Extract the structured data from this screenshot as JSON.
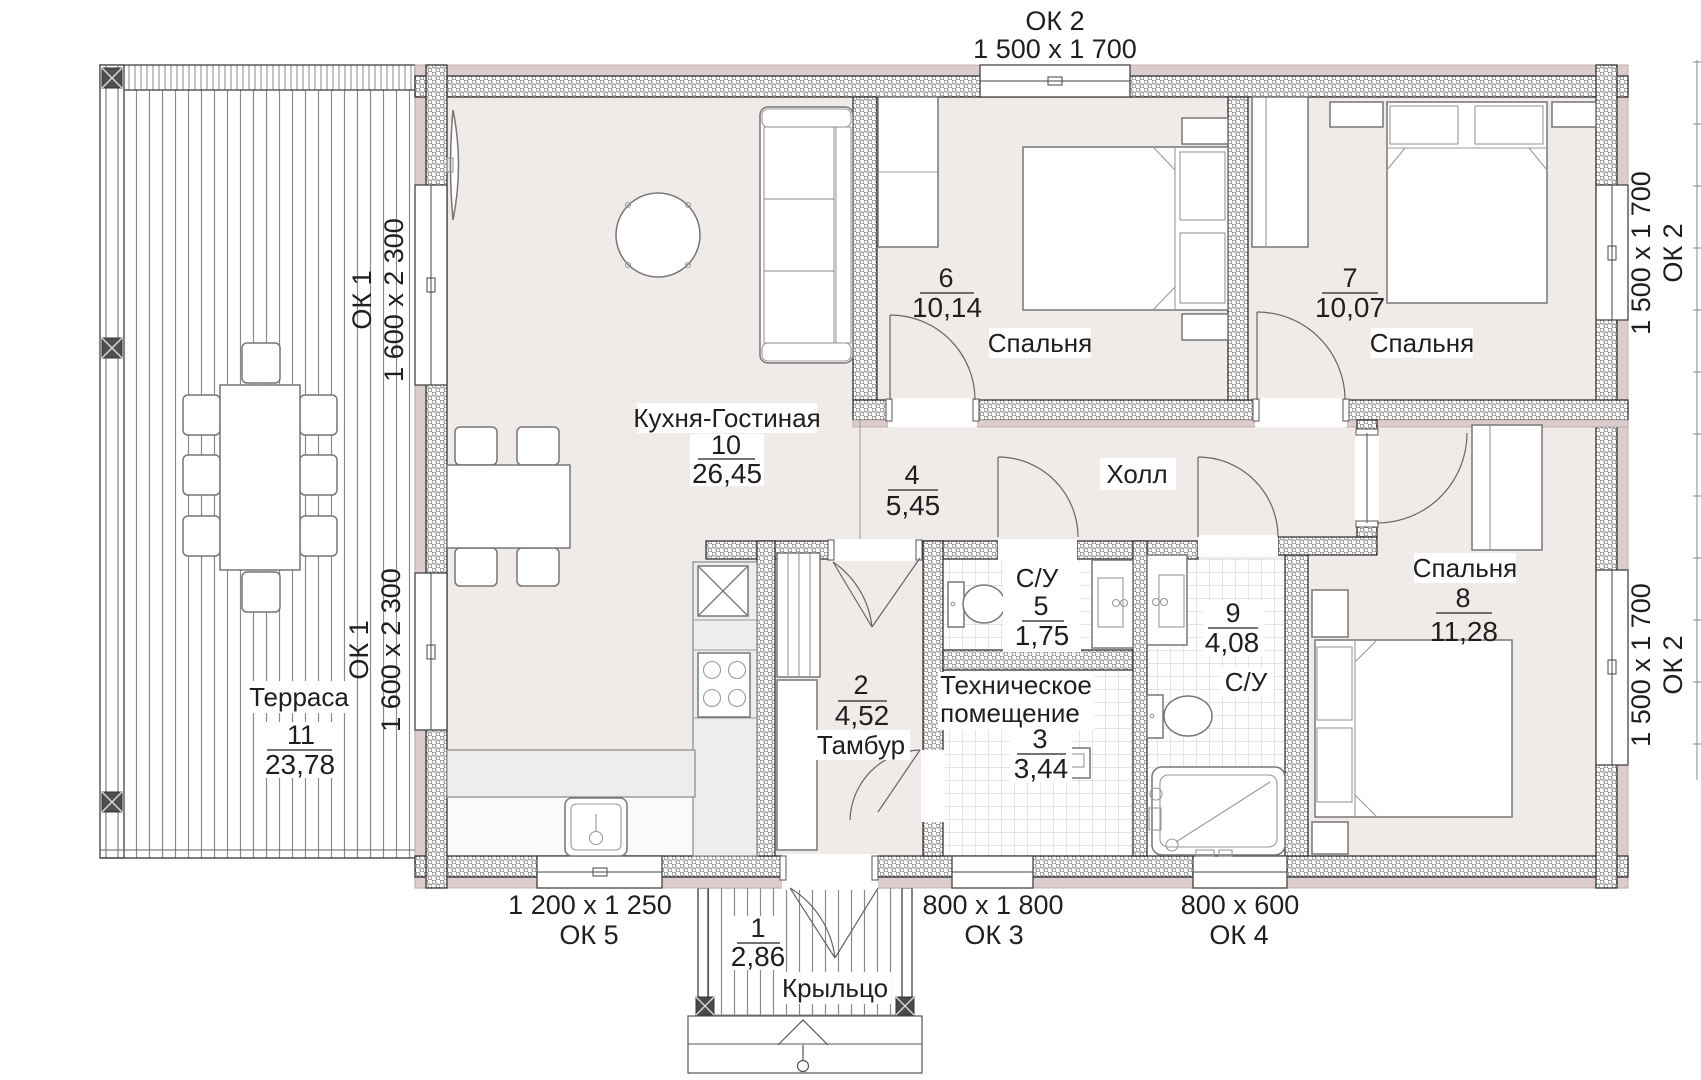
{
  "rooms": [
    {
      "number": "1",
      "area": "2,86",
      "name": "Крыльцо"
    },
    {
      "number": "2",
      "area": "4,52",
      "name": "Тамбур"
    },
    {
      "number": "3",
      "area": "3,44",
      "name": "Техническое помещение",
      "name_lines": [
        "Техническое",
        "помещение"
      ]
    },
    {
      "number": "4",
      "area": "5,45",
      "name": "Холл"
    },
    {
      "number": "5",
      "area": "1,75",
      "name": "С/У"
    },
    {
      "number": "6",
      "area": "10,14",
      "name": "Спальня"
    },
    {
      "number": "7",
      "area": "10,07",
      "name": "Спальня"
    },
    {
      "number": "8",
      "area": "11,28",
      "name": "Спальня"
    },
    {
      "number": "9",
      "area": "4,08",
      "name": "С/У"
    },
    {
      "number": "10",
      "area": "26,45",
      "name": "Кухня-Гостиная"
    },
    {
      "number": "11",
      "area": "23,78",
      "name": "Терраса"
    }
  ],
  "windows": [
    {
      "label": "ОК 1",
      "size": "1 600 x 2 300",
      "location": "left-upper"
    },
    {
      "label": "ОК 1",
      "size": "1 600 x 2 300",
      "location": "left-lower"
    },
    {
      "label": "ОК 2",
      "size": "1 500 x 1 700",
      "location": "top"
    },
    {
      "label": "ОК 2",
      "size": "1 500 x 1 700",
      "location": "right-upper"
    },
    {
      "label": "ОК 2",
      "size": "1 500 x 1 700",
      "location": "right-lower"
    },
    {
      "label": "ОК 5",
      "size": "1 200 x 1 250",
      "location": "bottom-left"
    },
    {
      "label": "ОК 3",
      "size": "800 x 1 800",
      "location": "bottom-middle"
    },
    {
      "label": "ОК 4",
      "size": "800 x 600",
      "location": "bottom-right"
    }
  ],
  "colors": {
    "wall_accent": "#dccccc",
    "floor": "#f0ebe9",
    "line": "#333333",
    "tile_line": "#cccccc",
    "deck_line": "#8a8a8a",
    "text": "#1f1f1f"
  }
}
